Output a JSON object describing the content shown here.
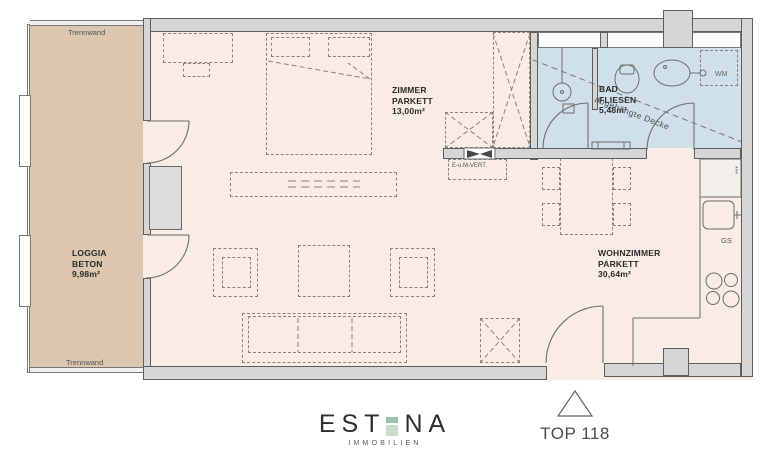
{
  "rooms": {
    "loggia": {
      "name": "LOGGIA",
      "floor": "BETON",
      "area": "9,98m²"
    },
    "zimmer": {
      "name": "ZIMMER",
      "floor": "PARKETT",
      "area": "13,00m²"
    },
    "bad": {
      "name": "BAD",
      "floor": "FLIESEN",
      "area": "5,48m²"
    },
    "wohnzimmer": {
      "name": "WOHNZIMMER",
      "floor": "PARKETT",
      "area": "30,64m²"
    }
  },
  "annotations": {
    "trennwand_top": "Trennwand",
    "trennwand_bottom": "Trennwand",
    "wm": "WM",
    "gs": "GS",
    "e_um_vert": "E-u.M-VERT.",
    "abgehaengte_decke": "abgehängte Decke"
  },
  "footer": {
    "brand_left": "EST",
    "brand_right": "NA",
    "brand_sub": "IMMOBILIEN",
    "unit": "TOP 118"
  },
  "colors": {
    "floor_parkett": "#f8ece4",
    "loggia_beton": "#dbc6b0",
    "bad_fliesen": "#d0e0ea",
    "wall": "#d6d6d6",
    "brand_green_light": "#c9dccb",
    "brand_green_dark": "#9cc0aa"
  }
}
